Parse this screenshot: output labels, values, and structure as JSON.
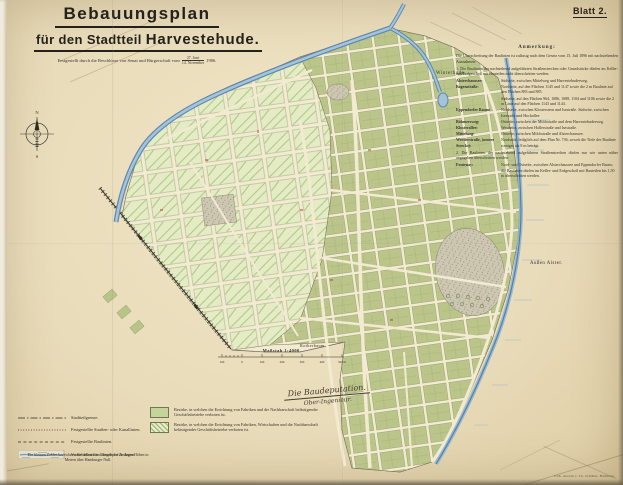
{
  "sheet": {
    "label": "Blatt 2."
  },
  "title": {
    "line1": "Bebauungsplan",
    "line2_small": "für den Stadtteil ",
    "line2_big": "Harvestehude.",
    "approval_prefix": "Festgestellt durch die Beschlüsse von Senat und Bürgerschaft vom",
    "date_top": "27. Juni",
    "date_bottom": "14. November",
    "year": "1906."
  },
  "anmerkung": {
    "heading": "Anmerkung:",
    "intro": "Die Überschreitung der Baulinien ist zulässig nach dem Gesetz vom 15. Juli 1896 mit nachstehenden Ausnahmen:",
    "item1": "1. Die Baulinien der nachstehend aufgeführten Straßenstrecken oder Grundstücke dürfen im Keller- und Erdgeschoß mit Bauteilen nicht überschritten werden:",
    "streets": [
      {
        "name": "Alsterchaussee:",
        "desc": "Südseite, zwischen Mittelweg und Harvestehuderweg."
      },
      {
        "name": "Bogenstraße:",
        "desc": "Nordseite, auf den Flächen 1145 und 1147 sowie die 2 m Baulinie auf den Flächen 883 und 885."
      },
      {
        "name": "",
        "desc": "Südseite, auf den Flächen 964, 1086, 1088, 1104 und 1106 sowie die 2 m Linie auf den Flächen 1143 und 1144."
      },
      {
        "name": "Eppendorfer Baum:",
        "desc": "Nordseite, zwischen Klosterstern und Isestraße. Südseite, zwischen Isestraße und Hochallee."
      },
      {
        "name": "Böhmersweg:",
        "desc": "Ostseite, zwischen der Milchstraße und dem Harvestehuderweg."
      },
      {
        "name": "Klosterallee:",
        "desc": "Westseite, zwischen Hallerstraße und Isestraße."
      },
      {
        "name": "Mittelweg:",
        "desc": "Ostseite, zwischen Milchstraße und Alsterchaussee."
      },
      {
        "name": "Werderstraße, (untere Strecke):",
        "desc": "Nordseite, lediglich auf dem Plan Nr. 736, soweit die Tiefe der Baulinie weniger als 8 m beträgt."
      }
    ],
    "item2": "2. Die Baulinien der nachstehend aufgeführten Straßenstrecken dürfen nur wie unten näher angegeben überschritten werden:",
    "streets2": [
      {
        "name": "Fontenay:",
        "desc": "Nord- und Ostseite, zwischen Alsterchaussee und Eppendorfer Baum; die Baulinien dürfen im Keller- und Erdgeschoß mit Bauteilen bis 1,50 m überschritten werden."
      }
    ]
  },
  "map": {
    "labels": {
      "winterhude": "Winterhude.",
      "aussen_alster": "Außen Alster.",
      "rotherbaum": "Rotherbaum.",
      "scale": "Maßstab 1:4000."
    },
    "scale_ticks": [
      "100",
      "0",
      "100",
      "200",
      "300",
      "400",
      "500 m"
    ],
    "compass": {
      "n": "N",
      "s": "S"
    }
  },
  "legend_lines": {
    "items": [
      {
        "label": "Stadtteilgrenze."
      },
      {
        "label": "Festgestellte Straßen- oder Kanallinien."
      },
      {
        "label": "Festgestellte Baulinien."
      },
      {
        "label": "Vorbehalten für öffentliche Anlagen."
      }
    ],
    "note": "Die kleinen Zahlen bezeichnen die definitiven Längenprofile, deren Höhen in Metern über Hamburger Null."
  },
  "legend_zones": {
    "items": [
      {
        "label": "Bezirke, in welchen die Errichtung von Fabriken und die Nachbarschaft belästigender Geschäftsbetriebe verboten ist."
      },
      {
        "label": "Bezirke, in welchen die Errichtung von Fabriken, Wirtschaften und die Nachbarschaft belästigender Geschäftsbetriebe verboten ist."
      }
    ]
  },
  "signature": {
    "line1": "Die Baudeputation.",
    "line2": "Ober-Ingenieur."
  },
  "imprint": "Lith. Anstalt v. Th. Schlüter, Hamburg.",
  "colors": {
    "paper": "#e9dcba",
    "map_cream": "#f2ead1",
    "green_hatch": "#cfe0a6",
    "green_solid": "#b9c488",
    "water": "#6f9cc4",
    "ink": "#2e2b24",
    "red": "#b5402e"
  }
}
